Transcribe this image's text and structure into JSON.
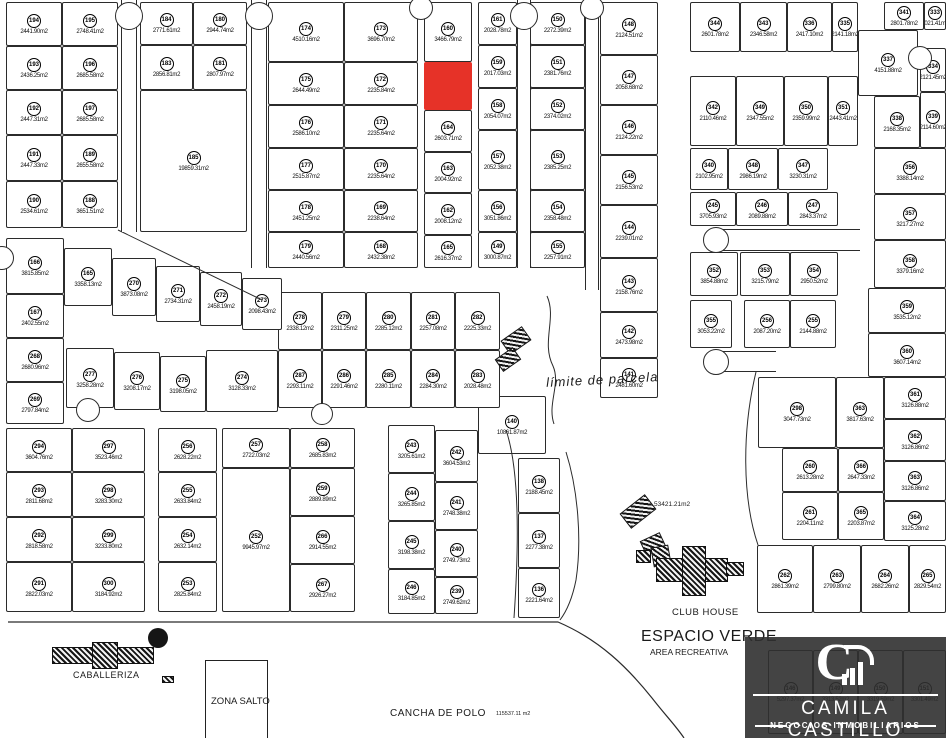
{
  "colors": {
    "red_lot": "#e63228",
    "line": "#2b2b2b"
  },
  "labels": {
    "caballeriza": "CABALLERIZA",
    "zona_salto": "ZONA SALTO",
    "cancha_de_polo": "CANCHA DE POLO",
    "cancha_area": "115537.11 m2",
    "club_house": "CLUB HOUSE",
    "espacio_verde": "ESPACIO VERDE",
    "area_recreativa": "AREA RECREATIVA",
    "espacio_verde_area": "53421.21m2",
    "limite_de_parcela": "límite de  parcela"
  },
  "logo": {
    "brand": "CAMILA CASTILLO",
    "tagline": "NEGOCIOS INMOBILIARIOS",
    "monogram": "C"
  },
  "lots": [
    [
      "194",
      "2441.90m2",
      6,
      2,
      56,
      44
    ],
    [
      "195",
      "2748.41m2",
      62,
      2,
      56,
      44
    ],
    [
      "193",
      "2436.25m2",
      6,
      46,
      56,
      44
    ],
    [
      "196",
      "2685.58m2",
      62,
      46,
      56,
      44
    ],
    [
      "192",
      "2447.31m2",
      6,
      90,
      56,
      45
    ],
    [
      "197",
      "2685.58m2",
      62,
      90,
      56,
      45
    ],
    [
      "191",
      "2447.33m2",
      6,
      135,
      56,
      46
    ],
    [
      "189",
      "2655.58m2",
      62,
      135,
      56,
      46
    ],
    [
      "190",
      "2534.61m2",
      6,
      181,
      56,
      47
    ],
    [
      "188",
      "3651.51m2",
      62,
      181,
      56,
      47
    ],
    [
      "184",
      "2771.61m2",
      140,
      2,
      53,
      43
    ],
    [
      "180",
      "2944.74m2",
      193,
      2,
      54,
      43
    ],
    [
      "183",
      "2856.81m2",
      140,
      45,
      53,
      45
    ],
    [
      "181",
      "2807.97m2",
      193,
      45,
      54,
      45
    ],
    [
      "185",
      "19859.31m2",
      140,
      90,
      107,
      142
    ],
    [
      "174",
      "4510.16m2",
      268,
      2,
      76,
      60
    ],
    [
      "173",
      "3696.70m2",
      344,
      2,
      74,
      60
    ],
    [
      "175",
      "2644.49m2",
      268,
      62,
      76,
      43
    ],
    [
      "172",
      "2235.84m2",
      344,
      62,
      74,
      43
    ],
    [
      "176",
      "2586.10m2",
      268,
      105,
      76,
      43
    ],
    [
      "171",
      "2235.64m2",
      344,
      105,
      74,
      43
    ],
    [
      "177",
      "2515.87m2",
      268,
      148,
      76,
      42
    ],
    [
      "170",
      "2235.64m2",
      344,
      148,
      74,
      42
    ],
    [
      "178",
      "2451.25m2",
      268,
      190,
      76,
      42
    ],
    [
      "169",
      "2238.64m2",
      344,
      190,
      74,
      42
    ],
    [
      "179",
      "2440.56m2",
      268,
      232,
      76,
      36
    ],
    [
      "168",
      "2432.38m2",
      344,
      232,
      74,
      36
    ],
    [
      "160",
      "3466.79m2",
      424,
      2,
      48,
      60
    ],
    [
      "",
      "",
      424,
      62,
      48,
      48,
      "red"
    ],
    [
      "164",
      "2603.71m2",
      424,
      110,
      48,
      42
    ],
    [
      "163",
      "2004.92m2",
      424,
      152,
      48,
      41
    ],
    [
      "162",
      "2008.12m2",
      424,
      193,
      48,
      42
    ],
    [
      "165",
      "2616.37m2",
      424,
      235,
      48,
      33
    ],
    [
      "161",
      "2028.78m2",
      478,
      2,
      39,
      43
    ],
    [
      "159",
      "2017.03m2",
      478,
      45,
      39,
      43
    ],
    [
      "158",
      "2054.07m2",
      478,
      88,
      39,
      42
    ],
    [
      "157",
      "2052.38m2",
      478,
      130,
      39,
      60
    ],
    [
      "156",
      "3051.86m2",
      478,
      190,
      39,
      42
    ],
    [
      "149",
      "3000.87m2",
      478,
      232,
      39,
      36
    ],
    [
      "150",
      "2272.39m2",
      530,
      2,
      55,
      43
    ],
    [
      "151",
      "2381.76m2",
      530,
      45,
      55,
      43
    ],
    [
      "152",
      "2374.02m2",
      530,
      88,
      55,
      42
    ],
    [
      "153",
      "2385.25m2",
      530,
      130,
      55,
      60
    ],
    [
      "154",
      "2358.48m2",
      530,
      190,
      55,
      42
    ],
    [
      "155",
      "2257.91m2",
      530,
      232,
      55,
      36
    ],
    [
      "148",
      "2124.51m2",
      600,
      2,
      58,
      53
    ],
    [
      "147",
      "2058.68m2",
      600,
      55,
      58,
      50
    ],
    [
      "146",
      "2124.22m2",
      600,
      105,
      58,
      50
    ],
    [
      "145",
      "2156.53m2",
      600,
      155,
      58,
      50
    ],
    [
      "144",
      "2239.01m2",
      600,
      205,
      58,
      53
    ],
    [
      "143",
      "2158.76m2",
      600,
      258,
      58,
      54
    ],
    [
      "142",
      "2473.98m2",
      600,
      312,
      58,
      46
    ],
    [
      "141",
      "2481.60m2",
      600,
      358,
      58,
      40
    ],
    [
      "140",
      "10861.87m2",
      478,
      396,
      68,
      58
    ],
    [
      "138",
      "2188.45m2",
      518,
      458,
      42,
      55
    ],
    [
      "137",
      "2277.38m2",
      518,
      513,
      42,
      55
    ],
    [
      "136",
      "2221.64m2",
      518,
      568,
      42,
      50
    ],
    [
      "278",
      "2338.12m2",
      278,
      292,
      44,
      58
    ],
    [
      "279",
      "2311.25m2",
      322,
      292,
      44,
      58
    ],
    [
      "280",
      "2285.12m2",
      366,
      292,
      45,
      58
    ],
    [
      "281",
      "2257.08m2",
      411,
      292,
      44,
      58
    ],
    [
      "282",
      "2225.33m2",
      455,
      292,
      45,
      58
    ],
    [
      "287",
      "2293.11m2",
      278,
      350,
      44,
      58
    ],
    [
      "286",
      "2291.46m2",
      322,
      350,
      44,
      58
    ],
    [
      "285",
      "2280.11m2",
      366,
      350,
      45,
      58
    ],
    [
      "284",
      "2284.30m2",
      411,
      350,
      44,
      58
    ],
    [
      "283",
      "2028.48m2",
      455,
      350,
      45,
      58
    ],
    [
      "166",
      "3815.85m2",
      6,
      238,
      58,
      56
    ],
    [
      "165",
      "3358.13m2",
      64,
      248,
      48,
      58
    ],
    [
      "270",
      "3873.08m2",
      112,
      258,
      44,
      58
    ],
    [
      "271",
      "2734.31m2",
      156,
      266,
      44,
      56
    ],
    [
      "272",
      "2458.19m2",
      200,
      272,
      42,
      54
    ],
    [
      "273",
      "2098.43m2",
      242,
      278,
      40,
      52
    ],
    [
      "167",
      "2402.55m2",
      6,
      294,
      58,
      44
    ],
    [
      "268",
      "2680.96m2",
      6,
      338,
      58,
      44
    ],
    [
      "269",
      "2797.84m2",
      6,
      382,
      58,
      42
    ],
    [
      "277",
      "3258.28m2",
      66,
      348,
      48,
      60
    ],
    [
      "276",
      "3208.17m2",
      114,
      352,
      46,
      58
    ],
    [
      "275",
      "3198.05m2",
      160,
      356,
      46,
      56
    ],
    [
      "274",
      "3128.33m2",
      206,
      350,
      72,
      62
    ],
    [
      "294",
      "3604.76m2",
      6,
      428,
      66,
      44
    ],
    [
      "297",
      "3523.46m2",
      72,
      428,
      73,
      44
    ],
    [
      "293",
      "2811.68m2",
      6,
      472,
      66,
      45
    ],
    [
      "298",
      "3283.30m2",
      72,
      472,
      73,
      45
    ],
    [
      "292",
      "2818.58m2",
      6,
      517,
      66,
      45
    ],
    [
      "299",
      "3233.80m2",
      72,
      517,
      73,
      45
    ],
    [
      "291",
      "2822.03m2",
      6,
      562,
      66,
      50
    ],
    [
      "300",
      "3184.92m2",
      72,
      562,
      73,
      50
    ],
    [
      "256",
      "2628.22m2",
      158,
      428,
      59,
      44
    ],
    [
      "255",
      "2633.84m2",
      158,
      472,
      59,
      45
    ],
    [
      "254",
      "2632.14m2",
      158,
      517,
      59,
      45
    ],
    [
      "253",
      "2825.84m2",
      158,
      562,
      59,
      50
    ],
    [
      "257",
      "2722.03m2",
      222,
      428,
      68,
      40
    ],
    [
      "252",
      "9945.97m2",
      222,
      468,
      68,
      144
    ],
    [
      "258",
      "2685.83m2",
      290,
      428,
      65,
      40
    ],
    [
      "259",
      "2889.89m2",
      290,
      468,
      65,
      48
    ],
    [
      "266",
      "2914.55m2",
      290,
      516,
      65,
      48
    ],
    [
      "267",
      "2926.27m2",
      290,
      564,
      65,
      48
    ],
    [
      "243",
      "3205.61m2",
      388,
      425,
      47,
      48
    ],
    [
      "244",
      "3265.85m2",
      388,
      473,
      47,
      48
    ],
    [
      "245",
      "3198.38m2",
      388,
      521,
      47,
      48
    ],
    [
      "246",
      "3184.85m2",
      388,
      569,
      47,
      45
    ],
    [
      "242",
      "3604.53m2",
      435,
      430,
      43,
      52
    ],
    [
      "241",
      "2748.38m2",
      435,
      482,
      43,
      48
    ],
    [
      "240",
      "2749.73m2",
      435,
      530,
      43,
      47
    ],
    [
      "239",
      "2749.62m2",
      435,
      577,
      43,
      37
    ],
    [
      "344",
      "2601.78m2",
      690,
      2,
      50,
      50
    ],
    [
      "343",
      "2346.58m2",
      740,
      2,
      47,
      50
    ],
    [
      "336",
      "2417.10m2",
      787,
      2,
      45,
      50
    ],
    [
      "335",
      "2141.18m2",
      832,
      2,
      26,
      50
    ],
    [
      "341",
      "2801.78m2",
      884,
      2,
      40,
      28
    ],
    [
      "333",
      "2021.41m2",
      924,
      2,
      22,
      28
    ],
    [
      "337",
      "4151.88m2",
      858,
      30,
      60,
      66
    ],
    [
      "334",
      "2121.45m2",
      920,
      48,
      26,
      44
    ],
    [
      "338",
      "2168.35m2",
      874,
      96,
      46,
      52
    ],
    [
      "339",
      "2114.60m2",
      920,
      92,
      26,
      56
    ],
    [
      "342",
      "2110.46m2",
      690,
      76,
      46,
      70
    ],
    [
      "349",
      "2347.55m2",
      736,
      76,
      48,
      70
    ],
    [
      "350",
      "2359.99m2",
      784,
      76,
      44,
      70
    ],
    [
      "351",
      "2443.41m2",
      828,
      76,
      30,
      70
    ],
    [
      "340",
      "2102.95m2",
      690,
      148,
      38,
      42
    ],
    [
      "348",
      "2986.19m2",
      728,
      148,
      50,
      42
    ],
    [
      "347",
      "3230.31m2",
      778,
      148,
      50,
      42
    ],
    [
      "245",
      "3705.93m2",
      690,
      192,
      46,
      34
    ],
    [
      "246",
      "2089.88m2",
      736,
      192,
      52,
      34
    ],
    [
      "247",
      "2843.37m2",
      788,
      192,
      50,
      34
    ],
    [
      "352",
      "3854.88m2",
      690,
      252,
      48,
      44
    ],
    [
      "353",
      "3215.79m2",
      740,
      252,
      50,
      44
    ],
    [
      "354",
      "2950.52m2",
      790,
      252,
      48,
      44
    ],
    [
      "355",
      "3053.22m2",
      690,
      300,
      42,
      48
    ],
    [
      "256",
      "2087.20m2",
      744,
      300,
      46,
      48
    ],
    [
      "255",
      "2144.88m2",
      790,
      300,
      46,
      48
    ],
    [
      "356",
      "3388.14m2",
      874,
      148,
      72,
      46
    ],
    [
      "357",
      "3217.27m2",
      874,
      194,
      72,
      46
    ],
    [
      "358",
      "3379.16m2",
      874,
      240,
      72,
      48
    ],
    [
      "359",
      "3535.12m2",
      868,
      288,
      78,
      45
    ],
    [
      "360",
      "3607.14m2",
      868,
      333,
      78,
      44
    ],
    [
      "361",
      "3126.88m2",
      884,
      377,
      62,
      42
    ],
    [
      "362",
      "3126.86m2",
      884,
      419,
      62,
      42
    ],
    [
      "363",
      "3126.86m2",
      884,
      461,
      62,
      40
    ],
    [
      "364",
      "3125.28m2",
      884,
      501,
      62,
      40
    ],
    [
      "298",
      "3047.73m2",
      758,
      377,
      78,
      71
    ],
    [
      "363",
      "3817.63m2",
      836,
      377,
      48,
      71
    ],
    [
      "260",
      "2613.28m2",
      782,
      448,
      56,
      44
    ],
    [
      "366",
      "2647.33m2",
      838,
      448,
      46,
      44
    ],
    [
      "261",
      "2204.11m2",
      782,
      492,
      56,
      48
    ],
    [
      "365",
      "2203.87m2",
      838,
      492,
      46,
      48
    ],
    [
      "262",
      "2861.39m2",
      757,
      545,
      56,
      68
    ],
    [
      "263",
      "2799.80m2",
      813,
      545,
      48,
      68
    ],
    [
      "264",
      "2682.26m2",
      861,
      545,
      48,
      68
    ],
    [
      "265",
      "2829.54m2",
      909,
      545,
      37,
      68
    ],
    [
      "146",
      "5297.37m2",
      768,
      650,
      45,
      84
    ],
    [
      "149",
      "3313.52m2",
      813,
      650,
      45,
      84
    ],
    [
      "150",
      "3319.59m2",
      858,
      650,
      45,
      84
    ],
    [
      "151",
      "3301.49m2",
      903,
      650,
      43,
      84
    ]
  ],
  "stems": [
    [
      121,
      0,
      16,
      232,
      "lr"
    ],
    [
      251,
      0,
      16,
      268,
      "lr"
    ],
    [
      517,
      0,
      14,
      268,
      "lr"
    ],
    [
      585,
      0,
      14,
      290,
      "lr"
    ],
    [
      716,
      229,
      144,
      22,
      "tb"
    ],
    [
      716,
      351,
      60,
      21,
      "tb"
    ]
  ],
  "bulbs": [
    [
      129,
      16,
      14
    ],
    [
      259,
      16,
      14
    ],
    [
      421,
      8,
      12
    ],
    [
      524,
      16,
      14
    ],
    [
      592,
      8,
      12
    ],
    [
      88,
      410,
      12
    ],
    [
      322,
      414,
      11
    ],
    [
      716,
      240,
      13
    ],
    [
      716,
      362,
      13
    ],
    [
      920,
      58,
      12
    ],
    [
      2,
      258,
      12
    ]
  ],
  "icons": [
    [
      503,
      332,
      24,
      15,
      -35
    ],
    [
      497,
      352,
      20,
      13,
      -35
    ],
    [
      622,
      502,
      30,
      17,
      -38
    ],
    [
      642,
      536,
      20,
      14,
      -25
    ],
    [
      636,
      550,
      13,
      11,
      0
    ],
    [
      652,
      546,
      16,
      18,
      -10
    ],
    [
      656,
      558,
      70,
      22,
      0
    ],
    [
      682,
      546,
      22,
      48,
      0
    ],
    [
      726,
      562,
      16,
      12,
      0
    ],
    [
      52,
      647,
      100,
      15,
      0
    ],
    [
      92,
      642,
      24,
      25,
      0
    ],
    [
      162,
      676,
      10,
      5,
      0
    ]
  ]
}
